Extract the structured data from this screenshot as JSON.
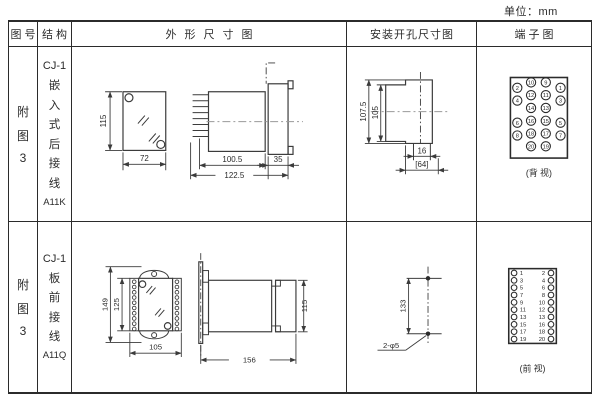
{
  "page": {
    "unit": "单位：mm"
  },
  "header": {
    "col_fig": "图号",
    "col_structure": "结构",
    "col_outline": "外形尺寸图",
    "col_install": "安装开孔尺寸图",
    "col_terminal": "端子图"
  },
  "rows": [
    {
      "fig_no": "附图3",
      "model": "CJ-1",
      "mount": "嵌入式后接线",
      "code": "A11K",
      "outline": {
        "front_h": "115",
        "front_w": "72",
        "body_len": "100.5",
        "total_len": "122.5",
        "panel_t": "35"
      },
      "install": {
        "outer_h": "107.5",
        "inner_h": "105",
        "notch_w": "16",
        "cut_w": "[64]"
      },
      "terminal": {
        "caption": "(背 视)",
        "outer_left": [
          "2",
          "4",
          "6",
          "8"
        ],
        "mid_left": [
          "10",
          "12",
          "14",
          "16",
          "18",
          "20"
        ],
        "mid_right": [
          "9",
          "11",
          "13",
          "15",
          "17",
          "19"
        ],
        "outer_right": [
          "1",
          "3",
          "5",
          "7"
        ]
      }
    },
    {
      "fig_no": "附图3",
      "model": "CJ-1",
      "mount": "板前接线",
      "code": "A11Q",
      "outline": {
        "front_h": "149",
        "inner_h": "125",
        "front_w": "105",
        "side_len": "156",
        "side_h": "115"
      },
      "install": {
        "hole_span": "133",
        "holes": "2-φ5"
      },
      "terminal": {
        "caption": "(前 视)",
        "left": [
          "1",
          "3",
          "5",
          "7",
          "9",
          "11",
          "13",
          "15",
          "17",
          "19"
        ],
        "right": [
          "2",
          "4",
          "6",
          "8",
          "10",
          "12",
          "13",
          "16",
          "18",
          "20"
        ]
      }
    }
  ]
}
